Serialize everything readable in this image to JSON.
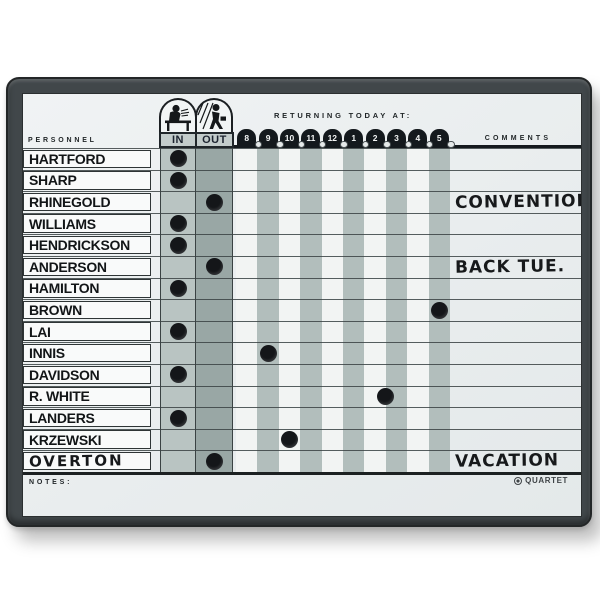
{
  "board": {
    "brand": "QUARTET",
    "header": {
      "personnel_label": "PERSONNEL",
      "in_label": "IN",
      "out_label": "OUT",
      "returning_label": "RETURNING TODAY AT:",
      "comments_label": "COMMENTS",
      "time_slots": [
        "8",
        "9",
        "10",
        "11",
        "12",
        "1",
        "2",
        "3",
        "4",
        "5"
      ]
    },
    "footer": {
      "notes_label": "NOTES:"
    },
    "rows": [
      {
        "name": "HARTFORD",
        "status": "in",
        "return_col_index": null,
        "return_slot_label": "",
        "comment": "",
        "handwritten_name": false
      },
      {
        "name": "SHARP",
        "status": "in",
        "return_col_index": null,
        "return_slot_label": "",
        "comment": "",
        "handwritten_name": false
      },
      {
        "name": "RHINEGOLD",
        "status": "out",
        "return_col_index": null,
        "return_slot_label": "",
        "comment": "CONVENTION",
        "handwritten_name": false
      },
      {
        "name": "WILLIAMS",
        "status": "in",
        "return_col_index": null,
        "return_slot_label": "",
        "comment": "",
        "handwritten_name": false
      },
      {
        "name": "HENDRICKSON",
        "status": "in",
        "return_col_index": null,
        "return_slot_label": "",
        "comment": "",
        "handwritten_name": false
      },
      {
        "name": "ANDERSON",
        "status": "out",
        "return_col_index": null,
        "return_slot_label": "",
        "comment": "BACK TUE.",
        "handwritten_name": false
      },
      {
        "name": "HAMILTON",
        "status": "in",
        "return_col_index": null,
        "return_slot_label": "",
        "comment": "",
        "handwritten_name": false
      },
      {
        "name": "BROWN",
        "status": "none",
        "return_col_index": 9,
        "return_slot_label": "5",
        "comment": "",
        "handwritten_name": false
      },
      {
        "name": "LAI",
        "status": "in",
        "return_col_index": null,
        "return_slot_label": "",
        "comment": "",
        "handwritten_name": false
      },
      {
        "name": "INNIS",
        "status": "none",
        "return_col_index": 1,
        "return_slot_label": "9",
        "comment": "",
        "handwritten_name": false
      },
      {
        "name": "DAVIDSON",
        "status": "in",
        "return_col_index": null,
        "return_slot_label": "",
        "comment": "",
        "handwritten_name": false
      },
      {
        "name": "R. WHITE",
        "status": "none",
        "return_col_index": 6.5,
        "return_slot_label": "between 2 and 3",
        "comment": "",
        "handwritten_name": false
      },
      {
        "name": "LANDERS",
        "status": "in",
        "return_col_index": null,
        "return_slot_label": "",
        "comment": "",
        "handwritten_name": false
      },
      {
        "name": "KRZEWSKI",
        "status": "none",
        "return_col_index": 2,
        "return_slot_label": "10",
        "comment": "",
        "handwritten_name": false
      },
      {
        "name": "OVERTON",
        "status": "out",
        "return_col_index": null,
        "return_slot_label": "",
        "comment": "VACATION",
        "handwritten_name": true
      }
    ],
    "colors": {
      "frame": "#41474a",
      "surface": "#edf0f1",
      "in_column": "#b9c4c2",
      "out_column": "#99a7a5",
      "stripe_gray": "#b2bebc",
      "stripe_white": "#f2f4f3",
      "grid_line": "#3a4243",
      "magnet": "#141619",
      "tab_black": "#14191d"
    }
  }
}
